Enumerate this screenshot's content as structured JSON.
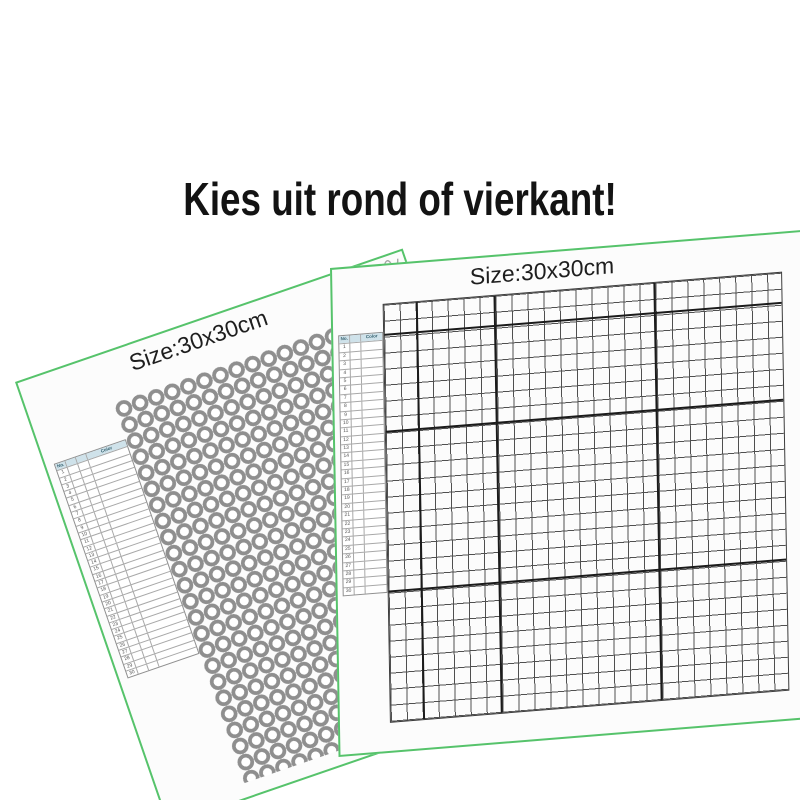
{
  "heading": {
    "text": "Kies uit rond of vierkant!",
    "color": "#131313"
  },
  "colors": {
    "green": "#56c36b",
    "ring": "#8f8f8f",
    "thin": "#4f4f4f",
    "thick": "#1b1b1b",
    "hdr": "#cfe2ea"
  },
  "canvases": {
    "round": {
      "size_label": "Size:30x30cm",
      "drill_shape": "round",
      "legend": {
        "headers": [
          "No.",
          "Color"
        ],
        "rows": [
          1,
          2,
          3,
          4,
          5,
          6,
          7,
          8,
          9,
          10,
          11,
          12,
          13,
          14,
          15,
          16,
          17,
          18,
          19,
          20,
          21,
          22,
          23,
          24,
          25,
          26,
          27,
          28,
          29,
          30
        ]
      }
    },
    "square": {
      "size_label": "Size:30x30cm",
      "drill_shape": "square",
      "legend": {
        "headers": [
          "No.",
          "Color"
        ],
        "rows": [
          1,
          2,
          3,
          4,
          5,
          6,
          7,
          8,
          9,
          10,
          11,
          12,
          13,
          14,
          15,
          16,
          17,
          18,
          19,
          20,
          21,
          22,
          23,
          24,
          25,
          26,
          27,
          28,
          29,
          30
        ]
      }
    }
  }
}
